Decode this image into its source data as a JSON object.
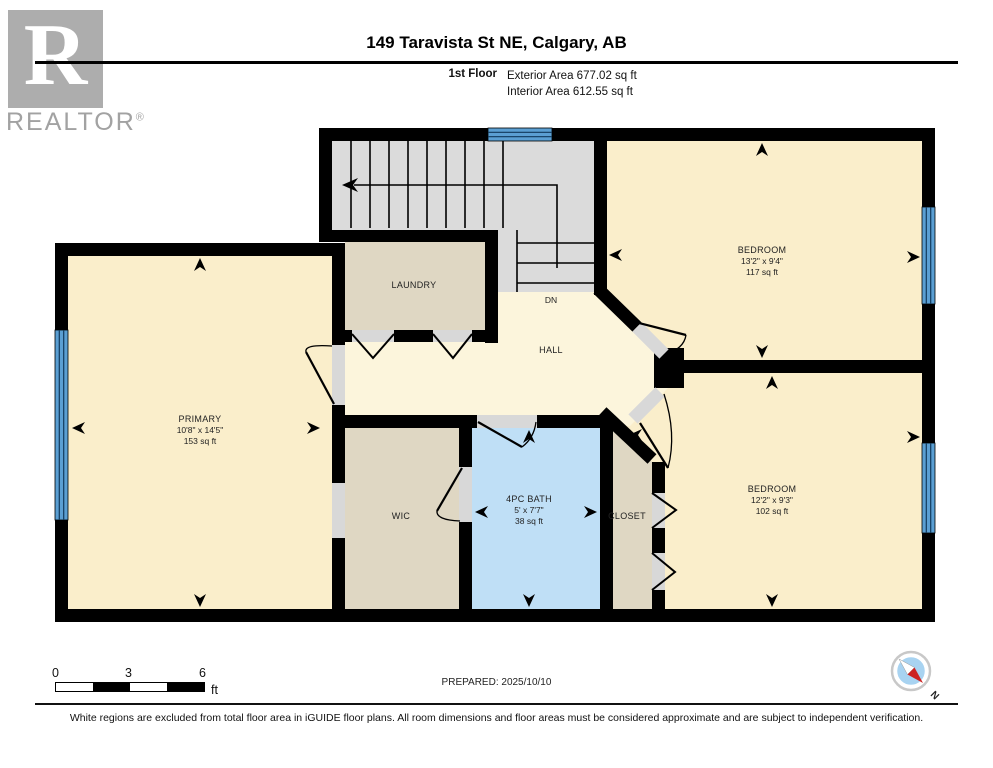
{
  "header": {
    "logo_letter": "R",
    "logo_word": "REALTOR",
    "logo_reg": "®",
    "title": "149 Taravista St NE, Calgary, AB",
    "floor_label": "1st Floor",
    "exterior_area": "Exterior Area 677.02 sq ft",
    "interior_area": "Interior Area 612.55 sq ft"
  },
  "plan": {
    "rooms": {
      "bedroom_top": {
        "name": "BEDROOM",
        "dims": "13'2\" x 9'4\"",
        "area": "117 sq ft"
      },
      "bedroom_bottom": {
        "name": "BEDROOM",
        "dims": "12'2\" x 9'3\"",
        "area": "102 sq ft"
      },
      "primary": {
        "name": "PRIMARY",
        "dims": "10'8\" x 14'5\"",
        "area": "153 sq ft"
      },
      "bath": {
        "name": "4PC BATH",
        "dims": "5' x 7'7\"",
        "area": "38 sq ft"
      },
      "laundry": {
        "name": "LAUNDRY"
      },
      "wic": {
        "name": "WIC"
      },
      "closet": {
        "name": "CLOSET"
      },
      "hall": {
        "name": "HALL"
      },
      "stairs": {
        "label": "DN"
      }
    },
    "colors": {
      "room_fill": "#FAEECB",
      "hall_fill": "#FCF5DC",
      "storage_fill": "#DFD7C3",
      "bath_fill": "#BFDFF6",
      "stairs_fill": "#DBDBDB",
      "window_blue": "#5B9FD3",
      "wall": "#000000"
    }
  },
  "footer": {
    "scale": {
      "start": "0",
      "mid": "3",
      "end": "6",
      "unit": "ft"
    },
    "prepared": "PREPARED: 2025/10/10",
    "compass_label": "N",
    "disclaimer": "White regions are excluded from total floor area in iGUIDE floor plans. All room dimensions and floor areas must be considered approximate and are subject to independent verification."
  }
}
